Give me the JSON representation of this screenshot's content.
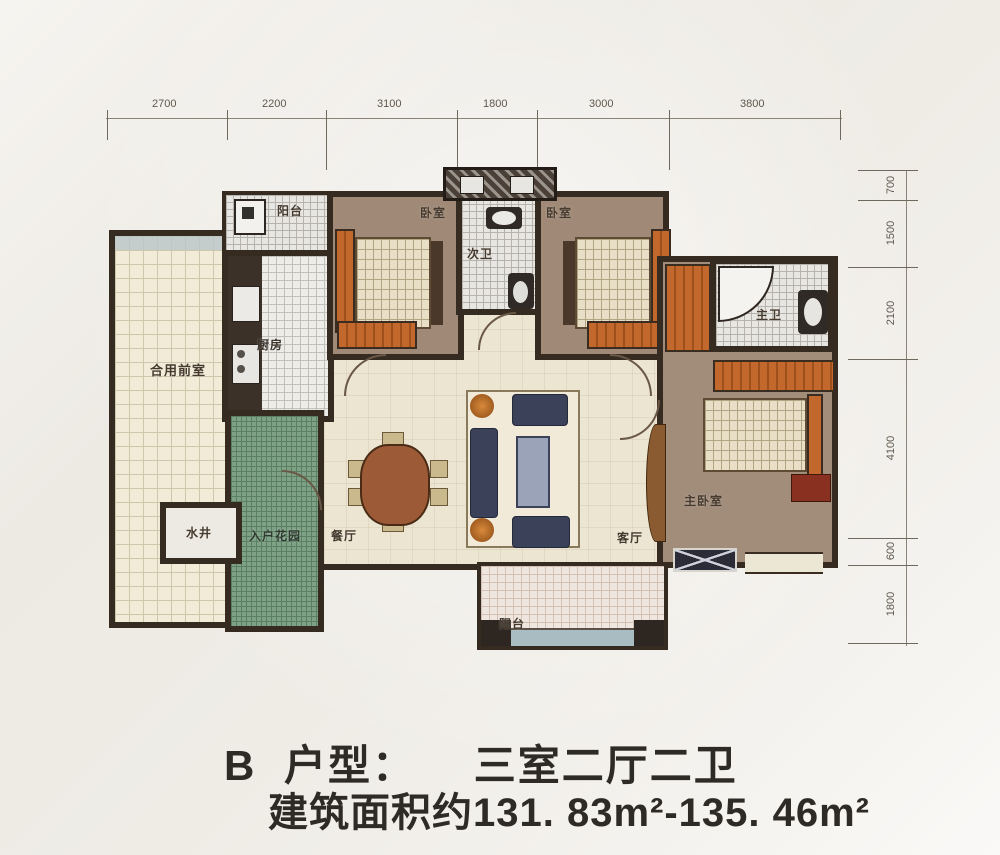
{
  "title": {
    "plan_letter": "B",
    "plan_label": "户型：",
    "plan_value": "三室二厅二卫",
    "area_line": "建筑面积约131. 83m²-135. 46m²"
  },
  "dimensions": {
    "top": [
      "2700",
      "2200",
      "3100",
      "1800",
      "3000",
      "3800"
    ],
    "right": [
      "700",
      "1500",
      "2100",
      "4100",
      "600",
      "1800"
    ]
  },
  "rooms": {
    "balcony_top": "阳台",
    "bedroom_left": "卧室",
    "bedroom_right": "卧室",
    "second_bath": "次卫",
    "kitchen": "厨房",
    "shared_front_room": "合用前室",
    "water_well": "水井",
    "entry_garden": "入户花园",
    "dining_room": "餐厅",
    "living_room": "客厅",
    "master_bath": "主卫",
    "master_bedroom": "主卧室",
    "balcony_bottom": "阳台"
  },
  "colors": {
    "wall": "#362b21",
    "bedroom_floor": "#a08a77",
    "open_floor": "#ece5d2",
    "garden_green": "#7fa286",
    "accent_orange": "#c2682c",
    "sofa_navy": "#3a4158",
    "text_dark": "#2e2a26"
  }
}
